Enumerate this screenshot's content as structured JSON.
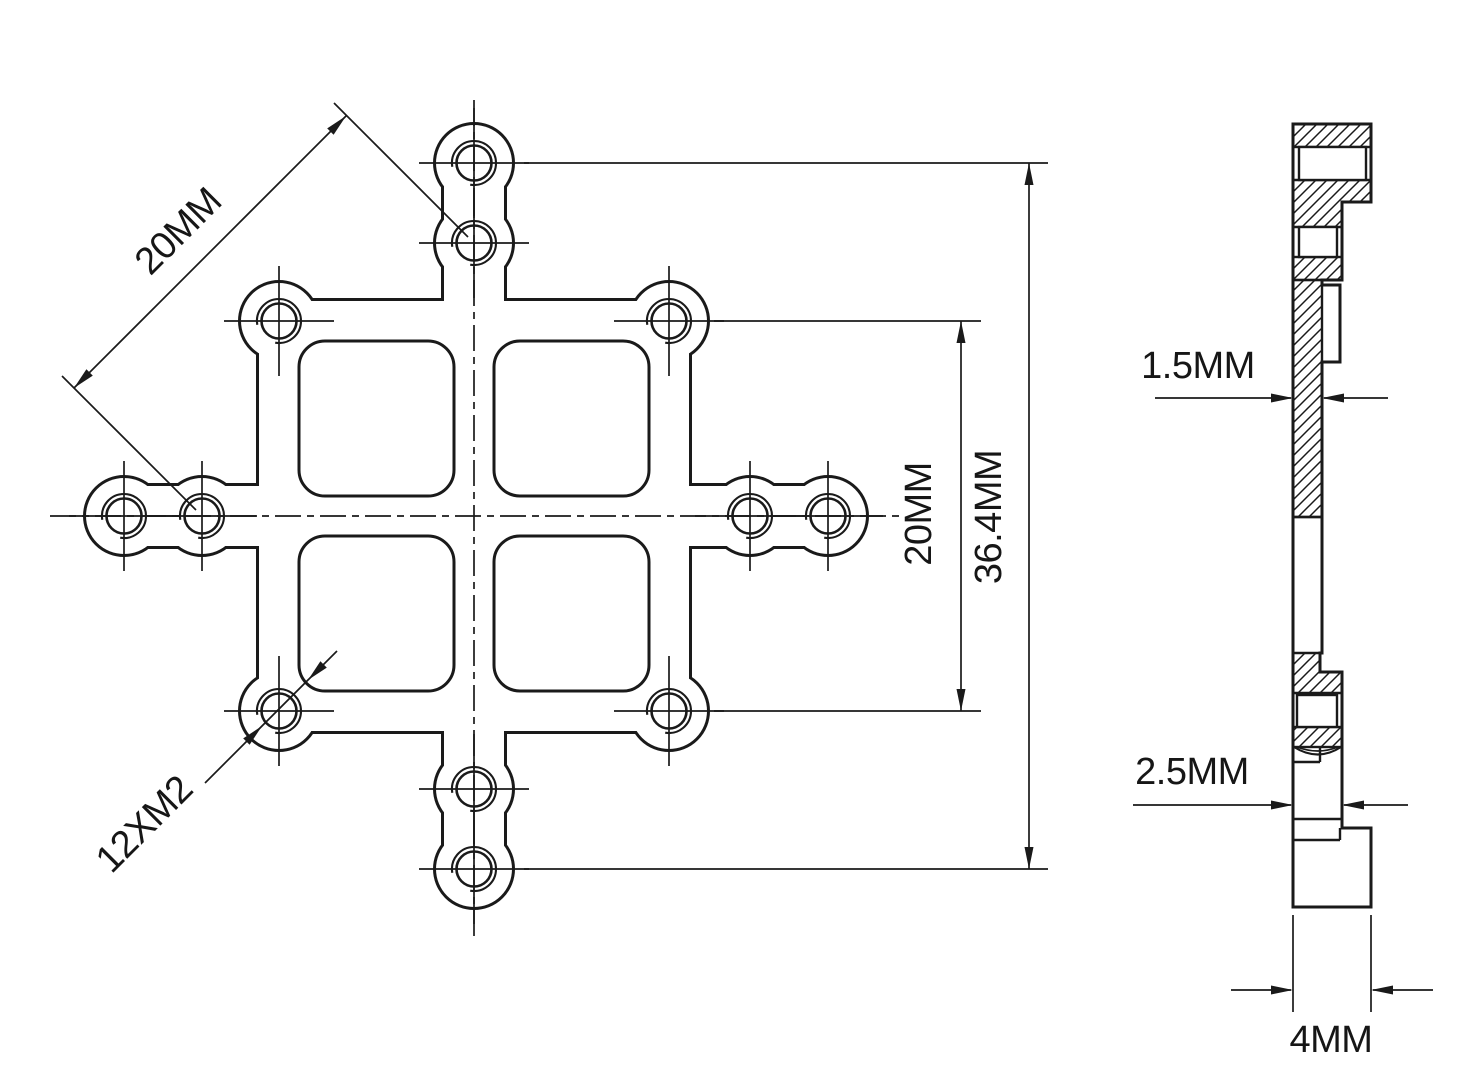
{
  "front_view": {
    "dim_diagonal": "20MM",
    "dim_vertical": "20MM",
    "dim_overall": "36.4MM",
    "thread_callout": "12XM2"
  },
  "side_view": {
    "dim_web": "1.5MM",
    "dim_mid": "2.5MM",
    "dim_base": "4MM"
  },
  "colors": {
    "line": "#1a1a1a",
    "background": "#ffffff"
  }
}
